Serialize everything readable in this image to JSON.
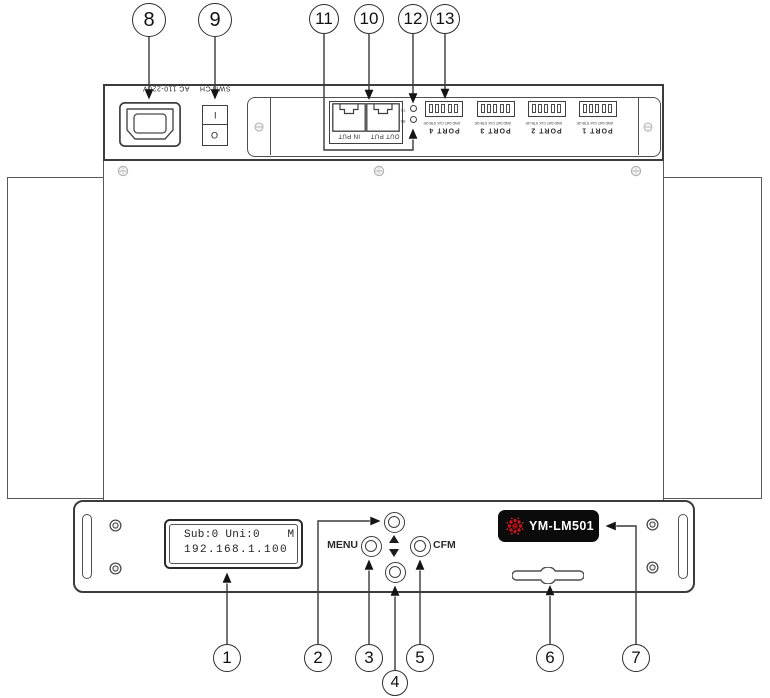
{
  "device": {
    "model": "YM-LM501",
    "view": "rear, top and front panel diagram"
  },
  "callouts": {
    "c1": "1",
    "c2": "2",
    "c3": "3",
    "c4": "4",
    "c5": "5",
    "c6": "6",
    "c7": "7",
    "c8": "8",
    "c9": "9",
    "c10": "10",
    "c11": "11",
    "c12": "12",
    "c13": "13"
  },
  "rear": {
    "power_label": "AC 110-220V",
    "switch_label": "SWITCH",
    "switch_on": "I",
    "switch_off": "O",
    "jack_in_label": "IN PUT",
    "jack_out_label": "OUT PUT",
    "led_tx": "TX",
    "led_rx": "RX",
    "ports": [
      {
        "label": "PORT 4",
        "pins": "GND DAT CLK STB OE"
      },
      {
        "label": "PORT 3",
        "pins": "GND DAT CLK STB OE"
      },
      {
        "label": "PORT 2",
        "pins": "GND DAT CLK STB OE"
      },
      {
        "label": "PORT 1",
        "pins": "GND DAT CLK STB OE"
      }
    ]
  },
  "front": {
    "lcd": {
      "line1": "Sub:0 Uni:0    M",
      "line2": "192.168.1.100"
    },
    "menu_label": "MENU",
    "cfm_label": "CFM",
    "badge_model": "YM-LM501"
  },
  "colors": {
    "line": "#3c3c3c",
    "badge_bg": "#0b0b0b",
    "logo_red": "#c4161c",
    "badge_text": "#ffffff"
  }
}
